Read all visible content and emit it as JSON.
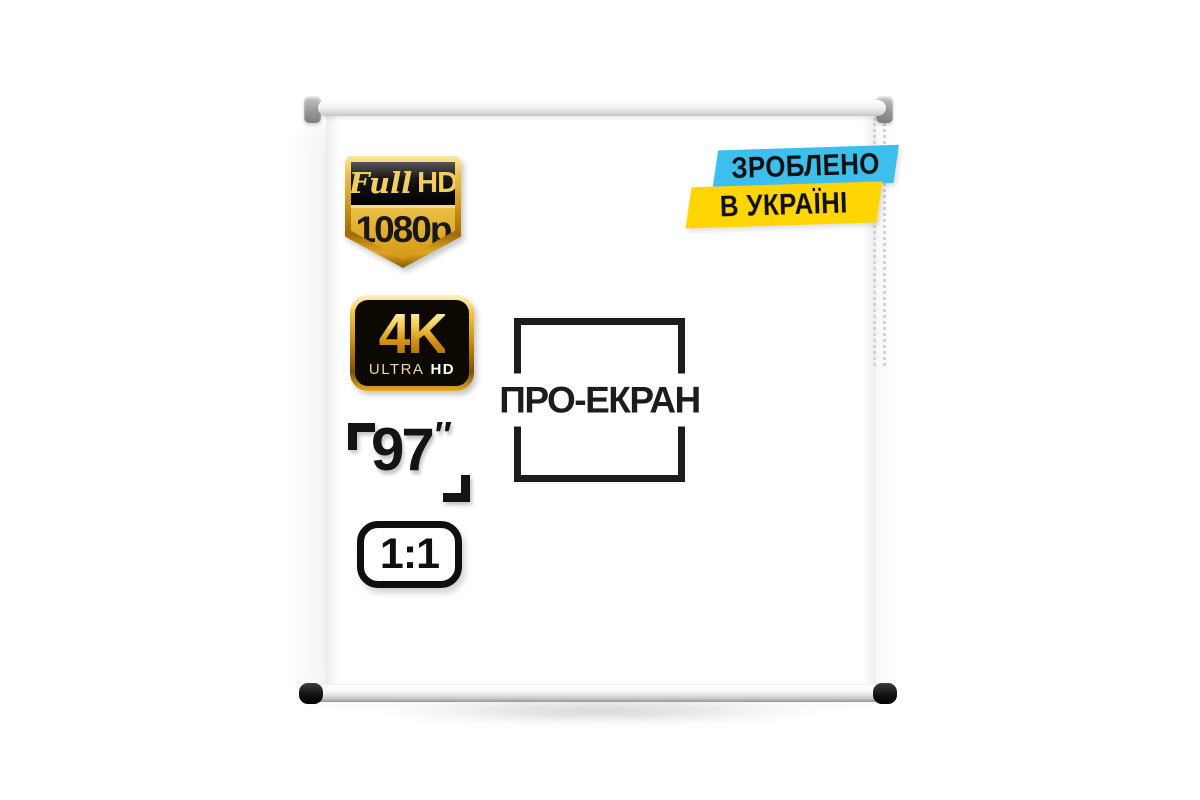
{
  "brand": {
    "logo_text": "ПРО-ЕКРАН"
  },
  "badges": {
    "full_hd": {
      "script": "Full",
      "hd": "HD",
      "resolution": "1080p",
      "gold": "#d09a1d",
      "panel_black": "#0d0d0d"
    },
    "ultra_hd": {
      "main": "4K",
      "sub_light": "ULTRA",
      "sub_bold": "HD",
      "gold": "#cd8c0e"
    },
    "diagonal": {
      "value": "97",
      "unit": "″"
    },
    "aspect_ratio": {
      "value": "1:1"
    },
    "made_in_ukraine": {
      "line1": "ЗРОБЛЕНО",
      "line2": "В УКРАЇНІ",
      "flag_blue": "#3cbfed",
      "flag_yellow": "#ffd504"
    }
  }
}
